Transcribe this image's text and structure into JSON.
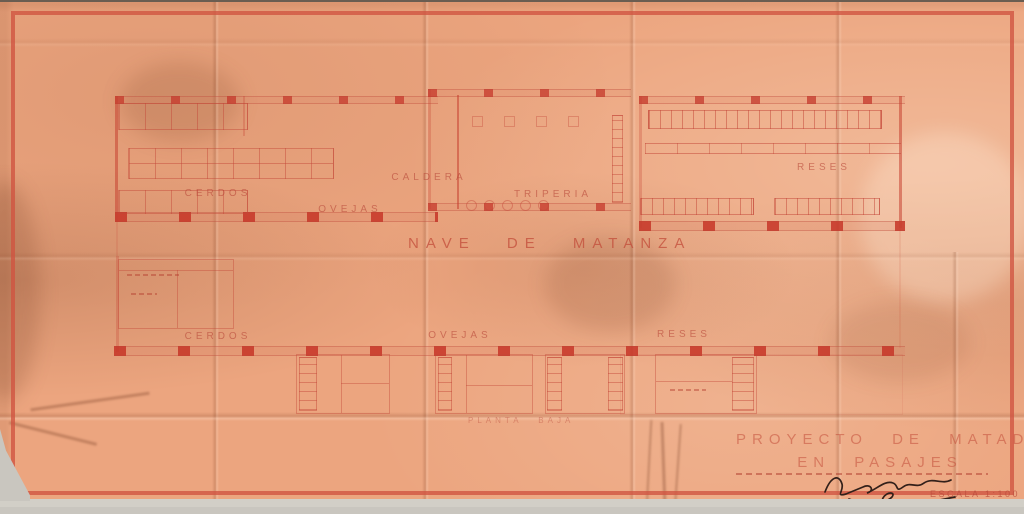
{
  "plan": {
    "title": "NAVE DE MATANZA",
    "floor": "PLANTA BAJA",
    "rooms": {
      "cerdos_top": "CERDOS",
      "ovejas_top": "OVEJAS",
      "caldera": "CALDERA",
      "triperia": "TRIPERIA",
      "reses_top": "RESES",
      "cerdos_bottom": "CERDOS",
      "ovejas_bottom": "OVEJAS",
      "reses_bottom": "RESES"
    }
  },
  "title_block": {
    "line1": "PROYECTO DE MATADERO",
    "line2": "EN PASAJES",
    "scale": "ESCALA 1:100"
  },
  "colors": {
    "paper": "#eca57f",
    "ink_red": "#c4473a",
    "border_red": "#cf5340",
    "scanner_bg": "#c9c6bf",
    "signature_ink": "#32201a"
  }
}
